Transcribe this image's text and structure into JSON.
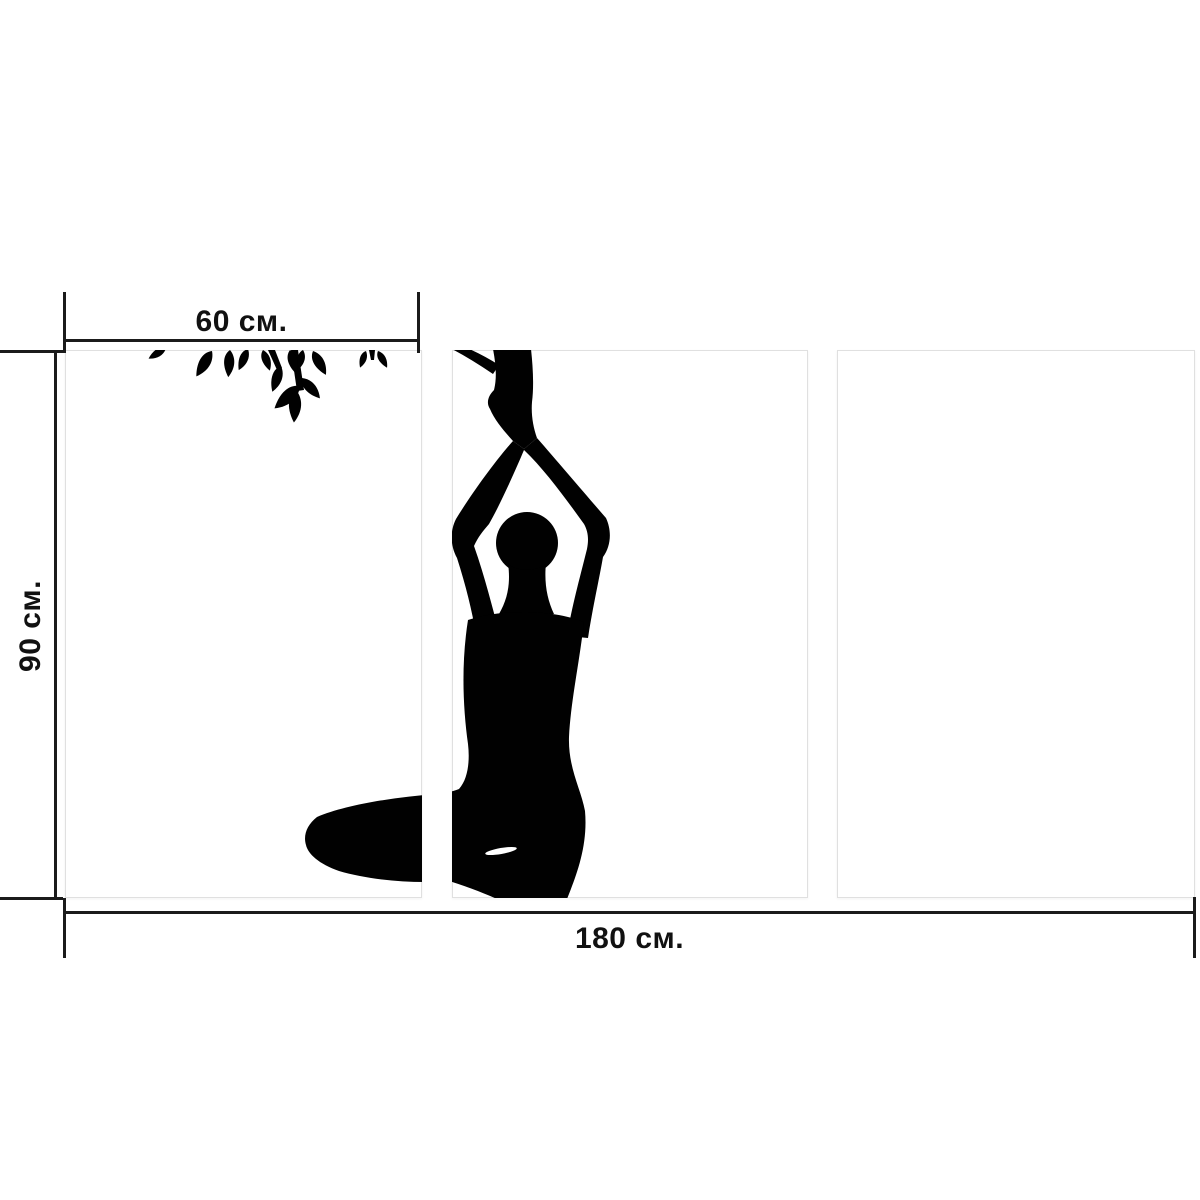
{
  "product": {
    "type_label": "triptych-canvas-dimension-diagram",
    "artwork_subject": "yoga-figure-silhouette-under-tree-branch"
  },
  "dimensions": {
    "panel_width_label": "60 см.",
    "height_label": "90 см.",
    "total_width_label": "180 см."
  },
  "panels": [
    {
      "name": "left-panel",
      "content": "leaves-and-knee-silhouette"
    },
    {
      "name": "center-panel",
      "content": "yoga-figure-and-branch-silhouette"
    },
    {
      "name": "right-panel",
      "content": "blank"
    }
  ],
  "colors": {
    "background": "#ffffff",
    "panel_fill": "#ffffff",
    "panel_border": "#e0e0e0",
    "silhouette": "#010101",
    "dimension_lines": "#1b1b1b",
    "label_text": "#111111"
  }
}
